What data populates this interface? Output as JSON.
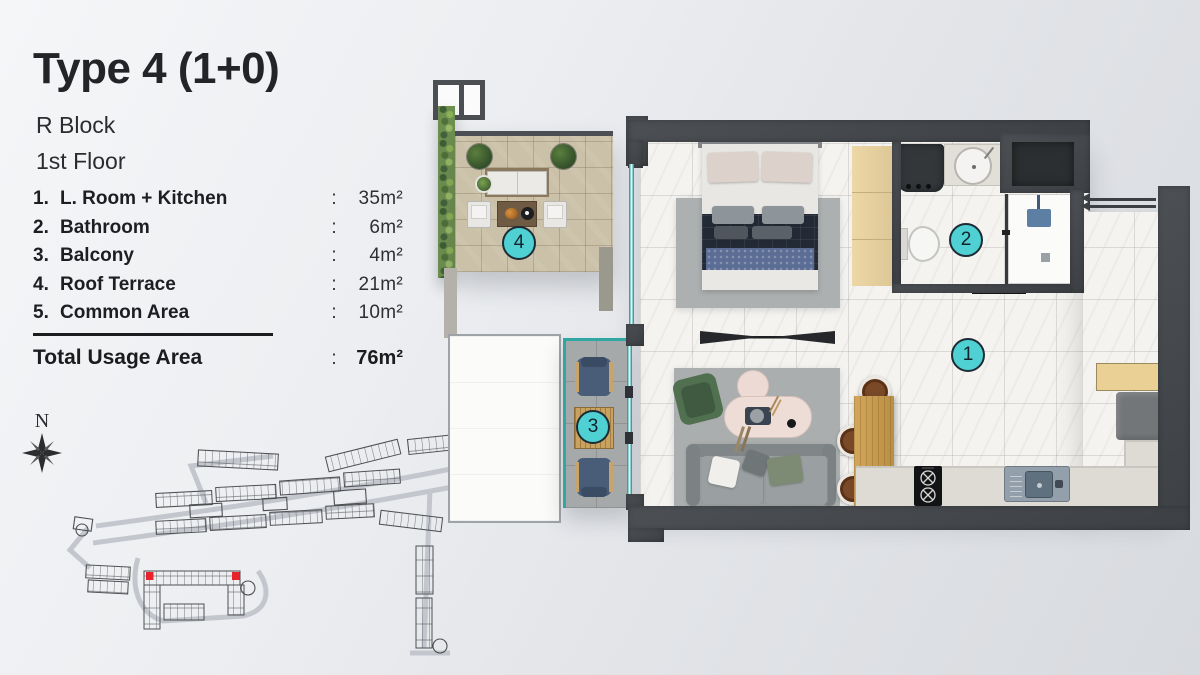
{
  "panel": {
    "title": "Type 4 (1+0)",
    "block": "R Block",
    "floor": "1st Floor",
    "colon": ":",
    "legend": [
      {
        "num": "1.",
        "name": "L. Room + Kitchen",
        "area": "35m²"
      },
      {
        "num": "2.",
        "name": "Bathroom",
        "area": "6m²"
      },
      {
        "num": "3.",
        "name": "Balcony",
        "area": "4m²"
      },
      {
        "num": "4.",
        "name": "Roof Terrace",
        "area": "21m²"
      },
      {
        "num": "5.",
        "name": "Common Area",
        "area": "10m²"
      }
    ],
    "total": {
      "label": "Total Usage Area",
      "area": "76m²"
    }
  },
  "site_map": {
    "compass_label": "N",
    "highlighted_units_count": 2
  },
  "plan": {
    "markers": [
      {
        "label": "1",
        "room": "L. Room + Kitchen"
      },
      {
        "label": "2",
        "room": "Bathroom"
      },
      {
        "label": "3",
        "room": "Balcony"
      },
      {
        "label": "4",
        "room": "Roof Terrace"
      }
    ]
  },
  "colors": {
    "accent": "#4FD0D3",
    "highlight": "#E8232B",
    "wall": "#45484B",
    "marble": "#F4F3F0",
    "terrace": "#CBC1A8",
    "balcony": "#A6A9A9",
    "glass": "#2FA8A3"
  }
}
